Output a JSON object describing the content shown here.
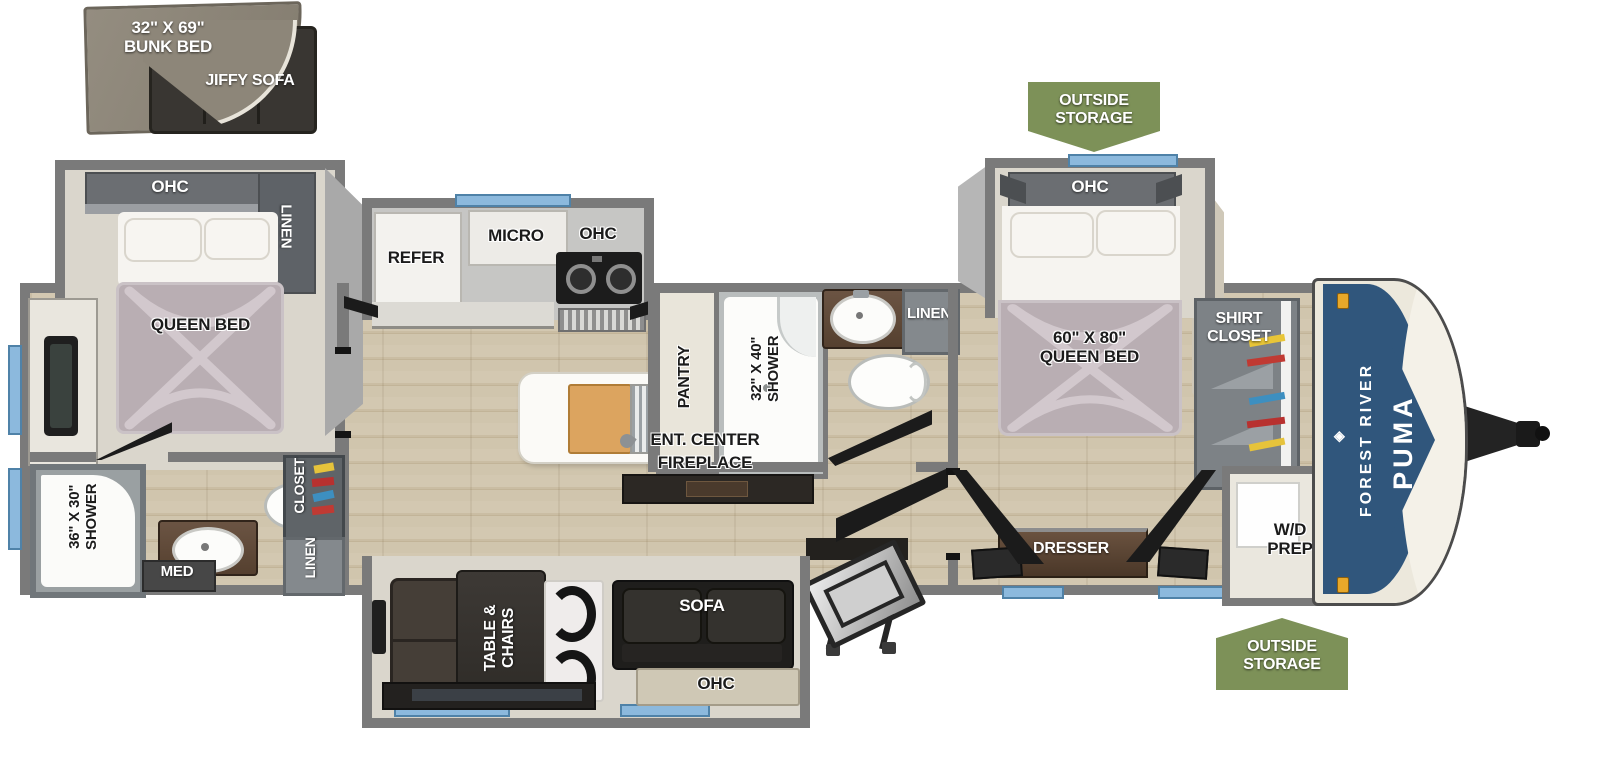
{
  "inset": {
    "bunk_bed": "32\" X 69\"\nBUNK BED",
    "jiffy_sofa": "JIFFY SOFA"
  },
  "rear_bedroom": {
    "ohc": "OHC",
    "linen": "LINEN",
    "bed": "QUEEN BED"
  },
  "rear_bath": {
    "shower": "36\" X 30\"\nSHOWER",
    "med": "MED",
    "closet": "CLOSET",
    "linen": "LINEN"
  },
  "kitchen": {
    "refer": "REFER",
    "micro": "MICRO",
    "ohc": "OHC",
    "pantry": "PANTRY"
  },
  "mid_bath": {
    "shower": "32\" X 40\"\nSHOWER",
    "linen": "LINEN"
  },
  "living": {
    "ent_center": "ENT. CENTER",
    "fireplace": "FIREPLACE",
    "table_chairs": "TABLE &\nCHAIRS",
    "sofa": "SOFA",
    "ohc": "OHC"
  },
  "front_bedroom": {
    "ohc": "OHC",
    "bed": "60\" X 80\"\nQUEEN BED",
    "shirt_closet": "SHIRT\nCLOSET",
    "dresser": "DRESSER",
    "wd_prep": "W/D\nPREP"
  },
  "badges": {
    "outside_storage": "OUTSIDE\nSTORAGE"
  },
  "brand": {
    "manufacturer": "FOREST RIVER",
    "model": "PUMA",
    "logo_glyph": "◈"
  },
  "colors": {
    "wall": "#7a7a7a",
    "floor_wood": "#cdc2ab",
    "carpet": "#dad6cc",
    "badge_green": "#7d9158",
    "cap_blue": "#30567c",
    "window_blue": "#8cb9dd",
    "mattress": "#b9aeb3",
    "furniture_dark": "#2c2824",
    "counter_brown": "#5d4a3c"
  }
}
